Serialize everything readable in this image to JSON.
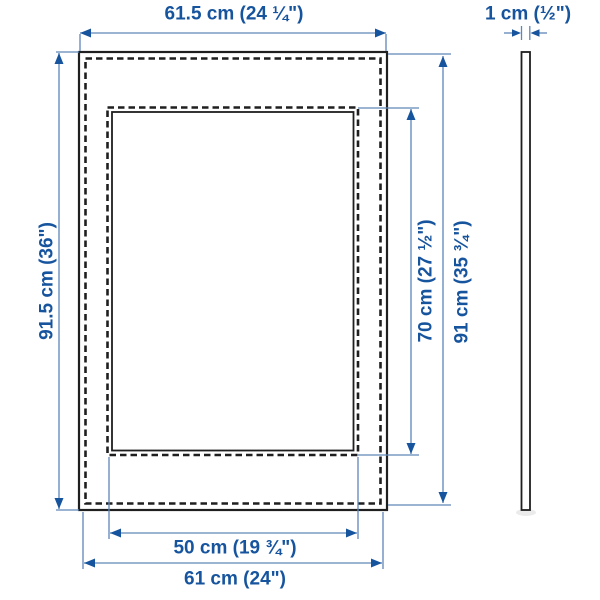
{
  "colors": {
    "accent_blue": "#17549e",
    "line_blue": "#5f86b8",
    "frame_black": "#1f1f1f",
    "background": "#ffffff"
  },
  "front_view": {
    "outer_width_label": "61.5 cm (24 ¼\")",
    "outer_height_label": "91.5 cm (36\")",
    "opening_height_label": "70 cm (27 ½\")",
    "right_height_label": "91 cm (35 ¾\")",
    "opening_width_label": "50 cm (19 ¾\")",
    "bottom_width_label": "61 cm (24\")"
  },
  "side_view": {
    "thickness_label": "1 cm (½\")"
  }
}
